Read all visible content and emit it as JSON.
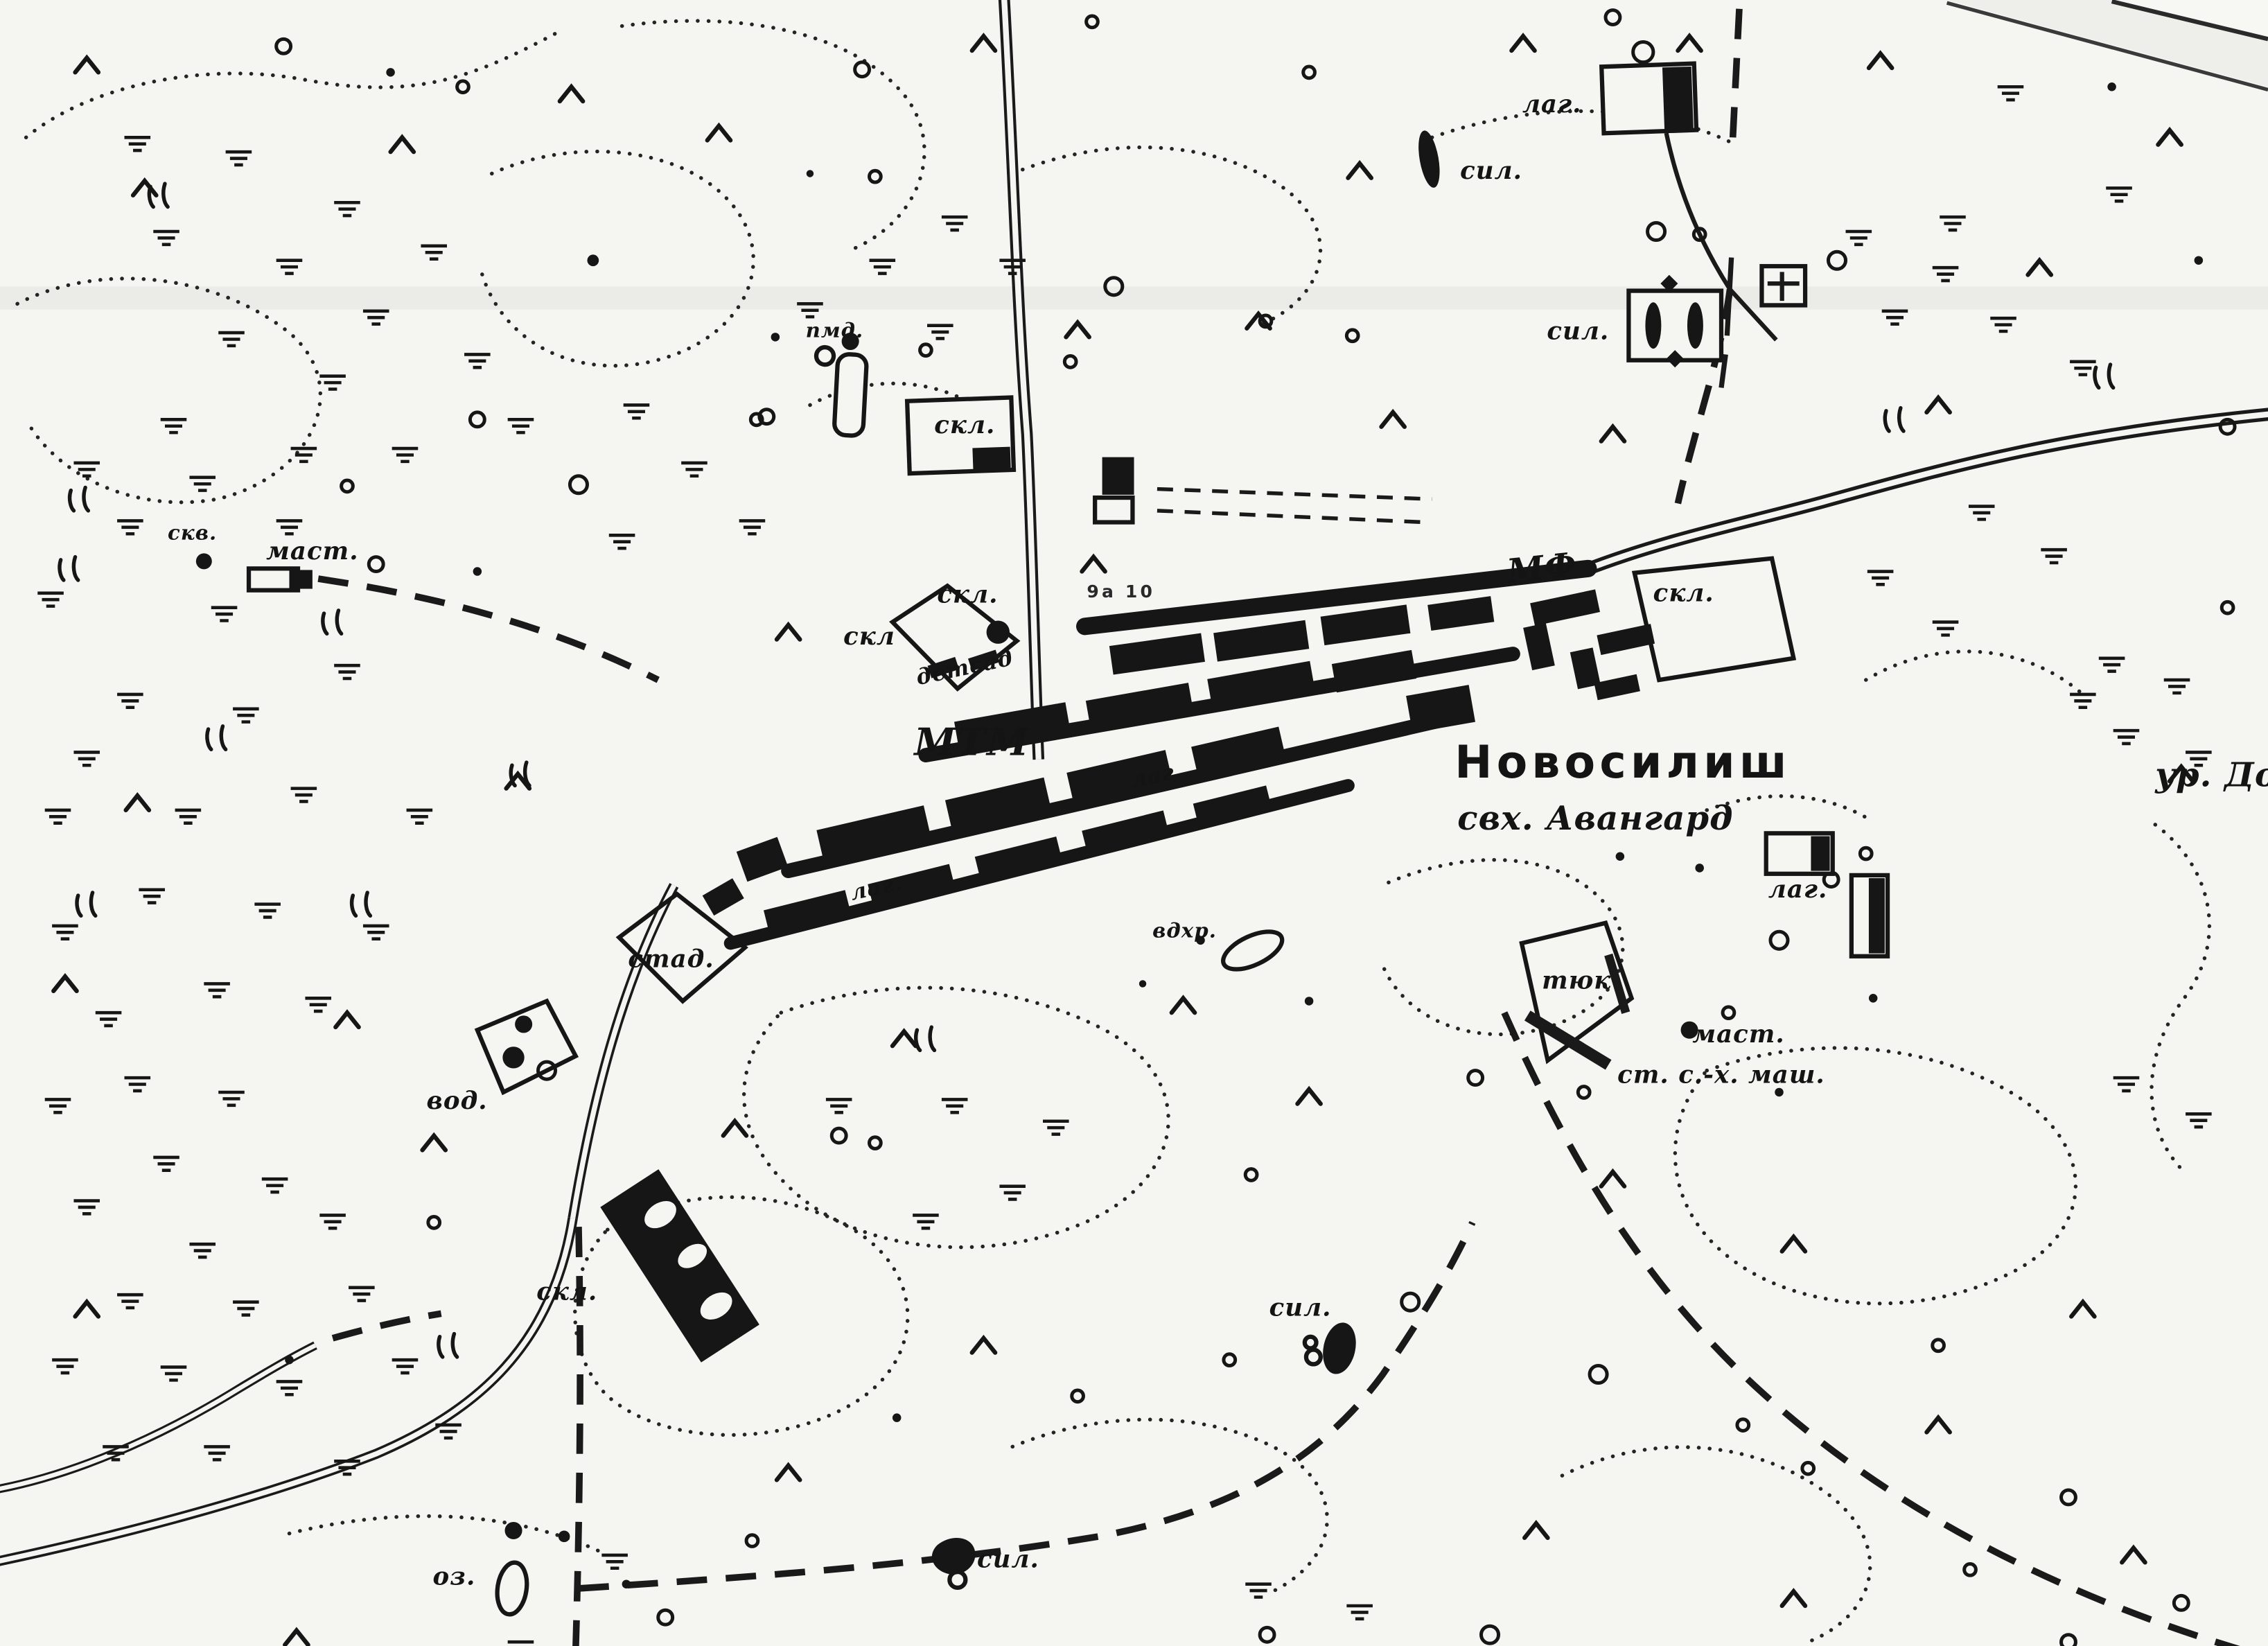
{
  "map": {
    "labels": {
      "lag_top": "лаг.",
      "sil_top": "сил.",
      "sil_ne": "сил.",
      "pmd": "пмд.",
      "skl_top": "скл.",
      "skv_w": "скв.",
      "mast_w": "маст.",
      "skl_c1": "скл.",
      "skl_c2": "скл",
      "detsad": "детсад",
      "mtm": "МТМ",
      "lag_c1": "лаг.",
      "lag_c2": "лаг",
      "spot": "9а 10",
      "mf": "МФ",
      "skl_e": "скл.",
      "settlement": "Новосилиш",
      "sovkhoz": "свх. Авангард",
      "ur": "ур. До",
      "lag_e": "лаг.",
      "tyuk": "тюк",
      "mast_e": "маст.",
      "st_mash": "ст. с.-х. маш.",
      "vdkhr": "вдхр.",
      "stad": "стад.",
      "vod": "вод.",
      "skl_sw": "скл.",
      "sil_se": "сил.",
      "oz": "оз.",
      "sil_s": "сил."
    },
    "ink_color": "#161616",
    "paper_color": "#f5f5f1"
  }
}
